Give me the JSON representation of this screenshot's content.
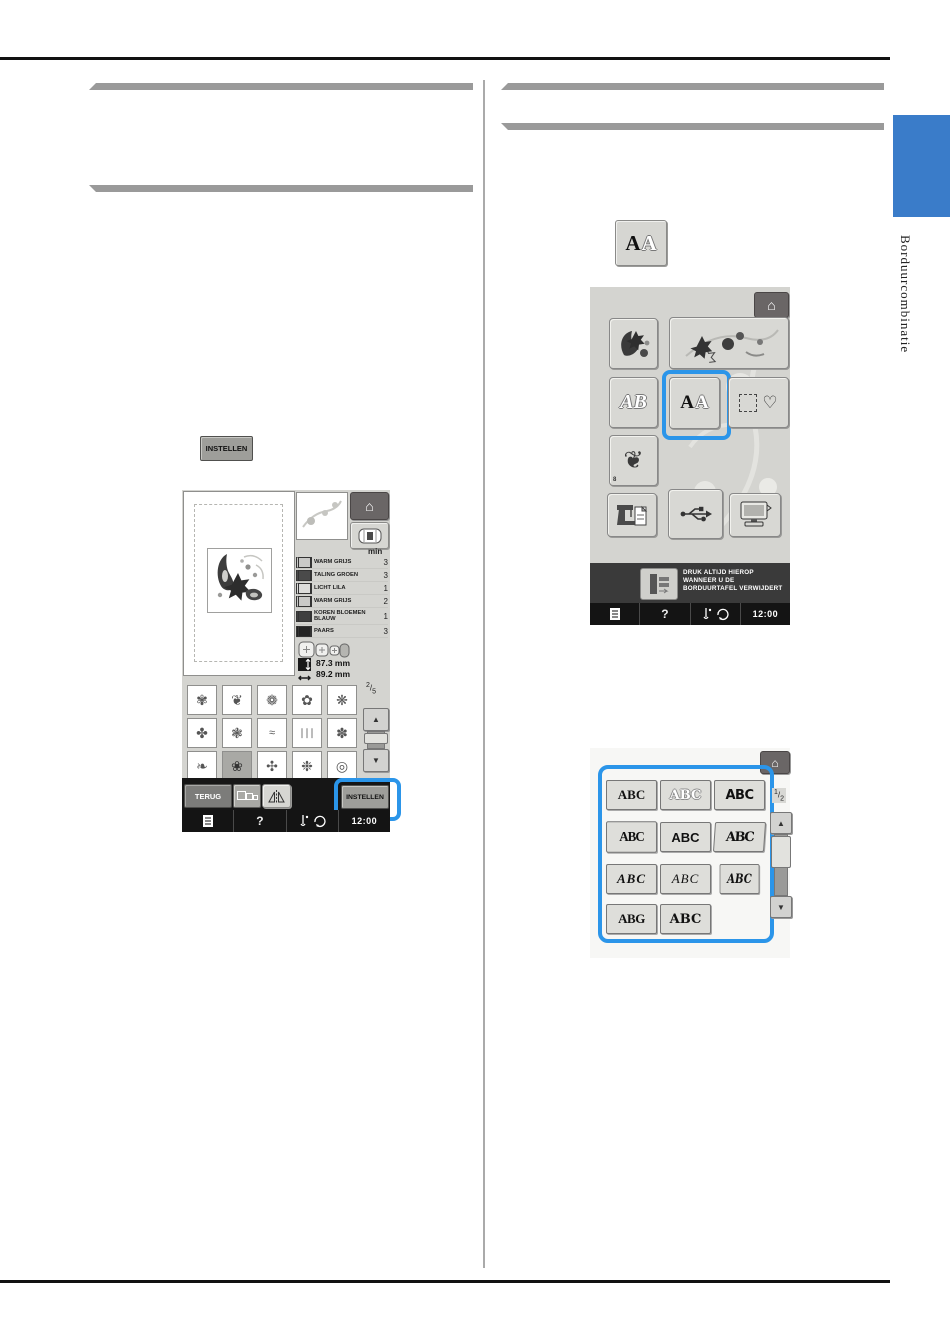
{
  "side_tab": {
    "label": "Borduurcombinatie",
    "tab_color": "#3a7cc9"
  },
  "accent": {
    "highlight_blue": "#2b95e9",
    "section_bar_gray": "#9a9a9a"
  },
  "icons": {
    "home": "⌂",
    "up_arrow": "▲",
    "down_arrow": "▼",
    "heart": "♡",
    "scroll_ornament": "❦"
  },
  "left_column": {
    "instellen_key_label": "INSTELLEN",
    "screen1": {
      "min_header": "min",
      "threads": [
        {
          "name": "WARM GRIJS",
          "min": "3",
          "color": "#c9c9c7"
        },
        {
          "name": "TALING GROEN",
          "min": "3",
          "color": "#4a4a4a"
        },
        {
          "name": "LICHT LILA",
          "min": "1",
          "color": "#dcdcda"
        },
        {
          "name": "WARM GRIJS",
          "min": "2",
          "color": "#c9c9c7"
        },
        {
          "name": "KOREN BLOEMEN BLAUW",
          "min": "1",
          "color": "#3f3f3f"
        },
        {
          "name": "PAARS",
          "min": "3",
          "color": "#232323"
        }
      ],
      "width_mm": "87.3 mm",
      "height_mm": "89.2 mm",
      "page_num": "2",
      "page_den": "5",
      "patterns": [
        "✾",
        "❦",
        "❁",
        "✿",
        "❋",
        "✤",
        "❃",
        "≈",
        "∣∣∣",
        "✽",
        "❧",
        "❀",
        "✣",
        "❉",
        "◎"
      ],
      "selected_pattern_index": 11,
      "terug_label": "TERUG",
      "instellen_label": "INSTELLEN",
      "help_label": "?",
      "time": "12:00"
    }
  },
  "right_column": {
    "aa_key": {
      "letter_solid": "A",
      "letter_outline": "A"
    },
    "screen2": {
      "ab_label": "AB",
      "scroll_badge": "8",
      "warning_line1": "DRUK ALTIJD HIEROP",
      "warning_line2": "WANNEER U DE",
      "warning_line3": "BORDUURTAFEL VERWIJDERT",
      "help_label": "?",
      "time": "12:00"
    },
    "screen3": {
      "page_num": "1",
      "page_den": "2",
      "fonts": [
        "ABC",
        "ABC",
        "ABC",
        "ABC",
        "ABC",
        "ABC",
        "ABC",
        "ABC",
        "ABC",
        "ABG",
        "ABC"
      ]
    }
  }
}
